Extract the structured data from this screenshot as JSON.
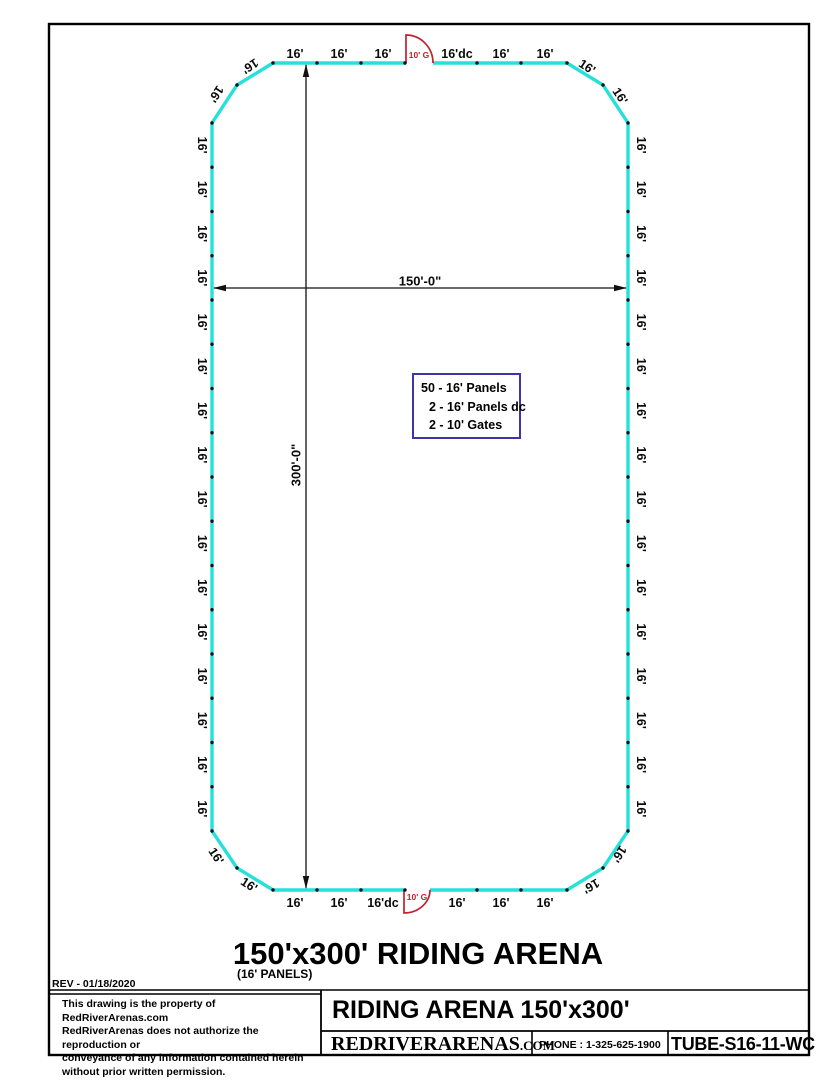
{
  "drawing": {
    "rev": "REV - 01/18/2020",
    "title": "150'x300' RIDING ARENA",
    "subtitle": "(16' PANELS)"
  },
  "legend": {
    "lines": [
      "50 - 16' Panels",
      "2 - 16' Panels dc",
      "2 - 10' Gates"
    ]
  },
  "arena": {
    "panel_label": "16'",
    "left_panel_count": 16,
    "right_panel_count": 16,
    "top_row_labels": [
      "16'",
      "16'",
      "16'",
      "16'dc",
      "16'",
      "16'"
    ],
    "bottom_row_labels": [
      "16'",
      "16'",
      "16'dc",
      "16'",
      "16'",
      "16'"
    ],
    "corner_labels": [
      "16'",
      "16'",
      "16'",
      "16'",
      "16'",
      "16'",
      "16'",
      "16'"
    ],
    "gate_label": "10' G",
    "width_dim": "150'-0\"",
    "height_dim": "300'-0\""
  },
  "title_block": {
    "copyright_lines": [
      "This drawing is the property of RedRiverArenas.com",
      "RedRiverArenas does not authorize the reproduction or",
      "conveyance of any information contained herein",
      "without prior written permission."
    ],
    "product_title": "RIDING ARENA 150'x300'",
    "brand": "REDRIVERARENAS",
    "brand_suffix": ".COM",
    "phone": "PHONE : 1-325-625-1900",
    "model": "TUBE-S16-11-WC"
  },
  "colors": {
    "arena_outline": "#25E1D9",
    "gate": "#C2222E",
    "legend_border": "#3A35A8"
  }
}
